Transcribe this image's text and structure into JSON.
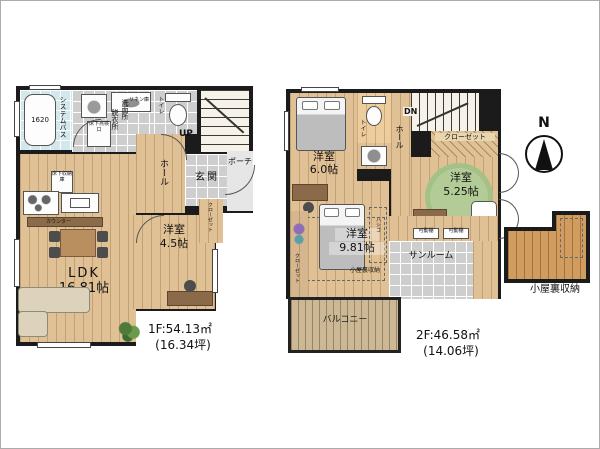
{
  "compass": {
    "n": "N"
  },
  "floor1": {
    "area": "1F:54.13㎡",
    "tsubo": "(16.34坪)",
    "ldk_name": "LDK",
    "ldk_size": "16.81帖",
    "west_room_name": "洋室",
    "west_room_size": "4.5帖",
    "entrance": "玄関",
    "hall": "ホール",
    "porch": "ポーチ",
    "toilet": "トイレ",
    "stairs_up": "UP",
    "bath_system": "システムバス",
    "bath_tub_size": "1620",
    "dressing_room": "脱衣所",
    "washroom": "洗面所",
    "linen": "リネン庫",
    "floor_hatch_wash": "床下点検口",
    "floor_storage_kitchen": "床下収納庫",
    "counter": "カウンター",
    "closet": "クローゼット"
  },
  "floor2": {
    "area": "2F:46.58㎡",
    "tsubo": "(14.06坪)",
    "room6_name": "洋室",
    "room6_size": "6.0帖",
    "room525_name": "洋室",
    "room525_size": "5.25帖",
    "room981_name": "洋室",
    "room981_size": "9.81帖",
    "toilet": "トイレ",
    "hall": "ホール",
    "stairs_dn": "DN",
    "closet_top": "クローゼット",
    "closet_left": "クローゼット",
    "sunroom": "サンルーム",
    "balcony": "バルコニー",
    "attic_access_note": "小屋裏収納",
    "ladder": "ハシゴ",
    "shelf_a": "可動棚",
    "shelf_b": "可動棚"
  },
  "attic": {
    "label": "小屋裏収納"
  },
  "colors": {
    "wall": "#1b1b1b",
    "wood_floor": "#e0c095",
    "tile": "#cecece",
    "bath": "#d2e8ec",
    "balcony": "#cdb896",
    "attic_wood": "#d09c60",
    "rug_green": "#a4c287"
  }
}
